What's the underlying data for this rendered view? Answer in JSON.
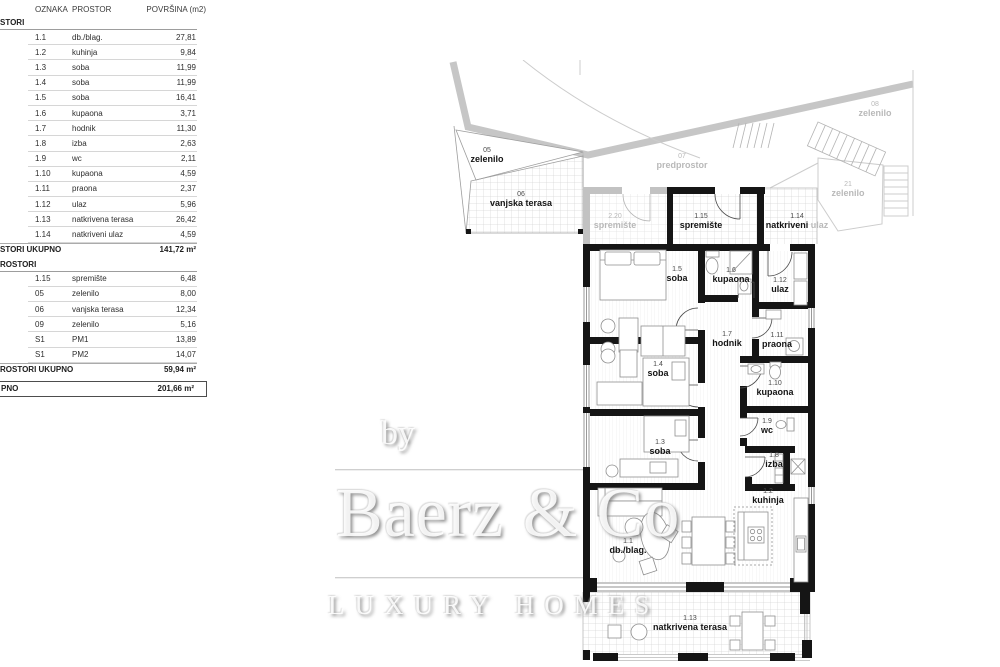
{
  "table": {
    "columns": {
      "oznaka": "OZNAKA",
      "prostor": "PROSTOR",
      "povrsina": "POVRŠINA (m2)"
    },
    "section_a": {
      "title": "STORI",
      "rows": [
        {
          "code": "1.1",
          "name": "db./blag.",
          "area": "27,81"
        },
        {
          "code": "1.2",
          "name": "kuhinja",
          "area": "9,84"
        },
        {
          "code": "1.3",
          "name": "soba",
          "area": "11,99"
        },
        {
          "code": "1.4",
          "name": "soba",
          "area": "11,99"
        },
        {
          "code": "1.5",
          "name": "soba",
          "area": "16,41"
        },
        {
          "code": "1.6",
          "name": "kupaona",
          "area": "3,71"
        },
        {
          "code": "1.7",
          "name": "hodnik",
          "area": "11,30"
        },
        {
          "code": "1.8",
          "name": "izba",
          "area": "2,63"
        },
        {
          "code": "1.9",
          "name": "wc",
          "area": "2,11"
        },
        {
          "code": "1.10",
          "name": "kupaona",
          "area": "4,59"
        },
        {
          "code": "1.11",
          "name": "praona",
          "area": "2,37"
        },
        {
          "code": "1.12",
          "name": "ulaz",
          "area": "5,96"
        },
        {
          "code": "1.13",
          "name": "natkrivena terasa",
          "area": "26,42"
        },
        {
          "code": "1.14",
          "name": "natkriveni ulaz",
          "area": "4,59"
        }
      ],
      "total_label": "STORI UKUPNO",
      "total_value": "141,72 m²"
    },
    "section_b": {
      "title": "ROSTORI",
      "rows": [
        {
          "code": "1.15",
          "name": "spremište",
          "area": "6,48"
        },
        {
          "code": "05",
          "name": "zelenilo",
          "area": "8,00"
        },
        {
          "code": "06",
          "name": "vanjska terasa",
          "area": "12,34"
        },
        {
          "code": "09",
          "name": "zelenilo",
          "area": "5,16"
        },
        {
          "code": "S1",
          "name": "PM1",
          "area": "13,89"
        },
        {
          "code": "S1",
          "name": "PM2",
          "area": "14,07"
        }
      ],
      "total_label": "ROSTORI UKUPNO",
      "total_value": "59,94 m²"
    },
    "grand_total": {
      "label": "PNO",
      "value": "201,66 m²"
    }
  },
  "plan": {
    "labels": [
      {
        "code": "05",
        "name": "zelenilo"
      },
      {
        "code": "06",
        "name": "vanjska terasa"
      },
      {
        "code": "07",
        "name": "predprostor"
      },
      {
        "code": "08",
        "name": "zelenilo"
      },
      {
        "code": "21",
        "name": "zelenilo"
      },
      {
        "code": "2.20",
        "name": "spremište"
      },
      {
        "code": "1.15",
        "name": "spremište"
      },
      {
        "code": "1.14",
        "name": "natkriveni",
        "suffix": "ulaz"
      },
      {
        "code": "1.5",
        "name": "soba"
      },
      {
        "code": "1.6",
        "name": "kupaona"
      },
      {
        "code": "1.12",
        "name": "ulaz"
      },
      {
        "code": "1.7",
        "name": "hodnik"
      },
      {
        "code": "1.11",
        "name": "praona"
      },
      {
        "code": "1.4",
        "name": "soba"
      },
      {
        "code": "1.10",
        "name": "kupaona"
      },
      {
        "code": "1.3",
        "name": "soba"
      },
      {
        "code": "1.9",
        "name": "wc"
      },
      {
        "code": "1.8",
        "name": "izba"
      },
      {
        "code": "1.2",
        "name": "kuhinja"
      },
      {
        "code": "1.1",
        "name": "db./blag."
      },
      {
        "code": "1.13",
        "name": "natkrivena terasa"
      }
    ],
    "colors": {
      "wall": "#151515",
      "neighbor_wall": "#c2c2c2",
      "grid_line": "#d6d6d6",
      "gray_label": "#b9b9b9"
    }
  },
  "watermark": {
    "by": "by",
    "brand": "Baerz & Co",
    "tagline": "LUXURY HOMES"
  }
}
